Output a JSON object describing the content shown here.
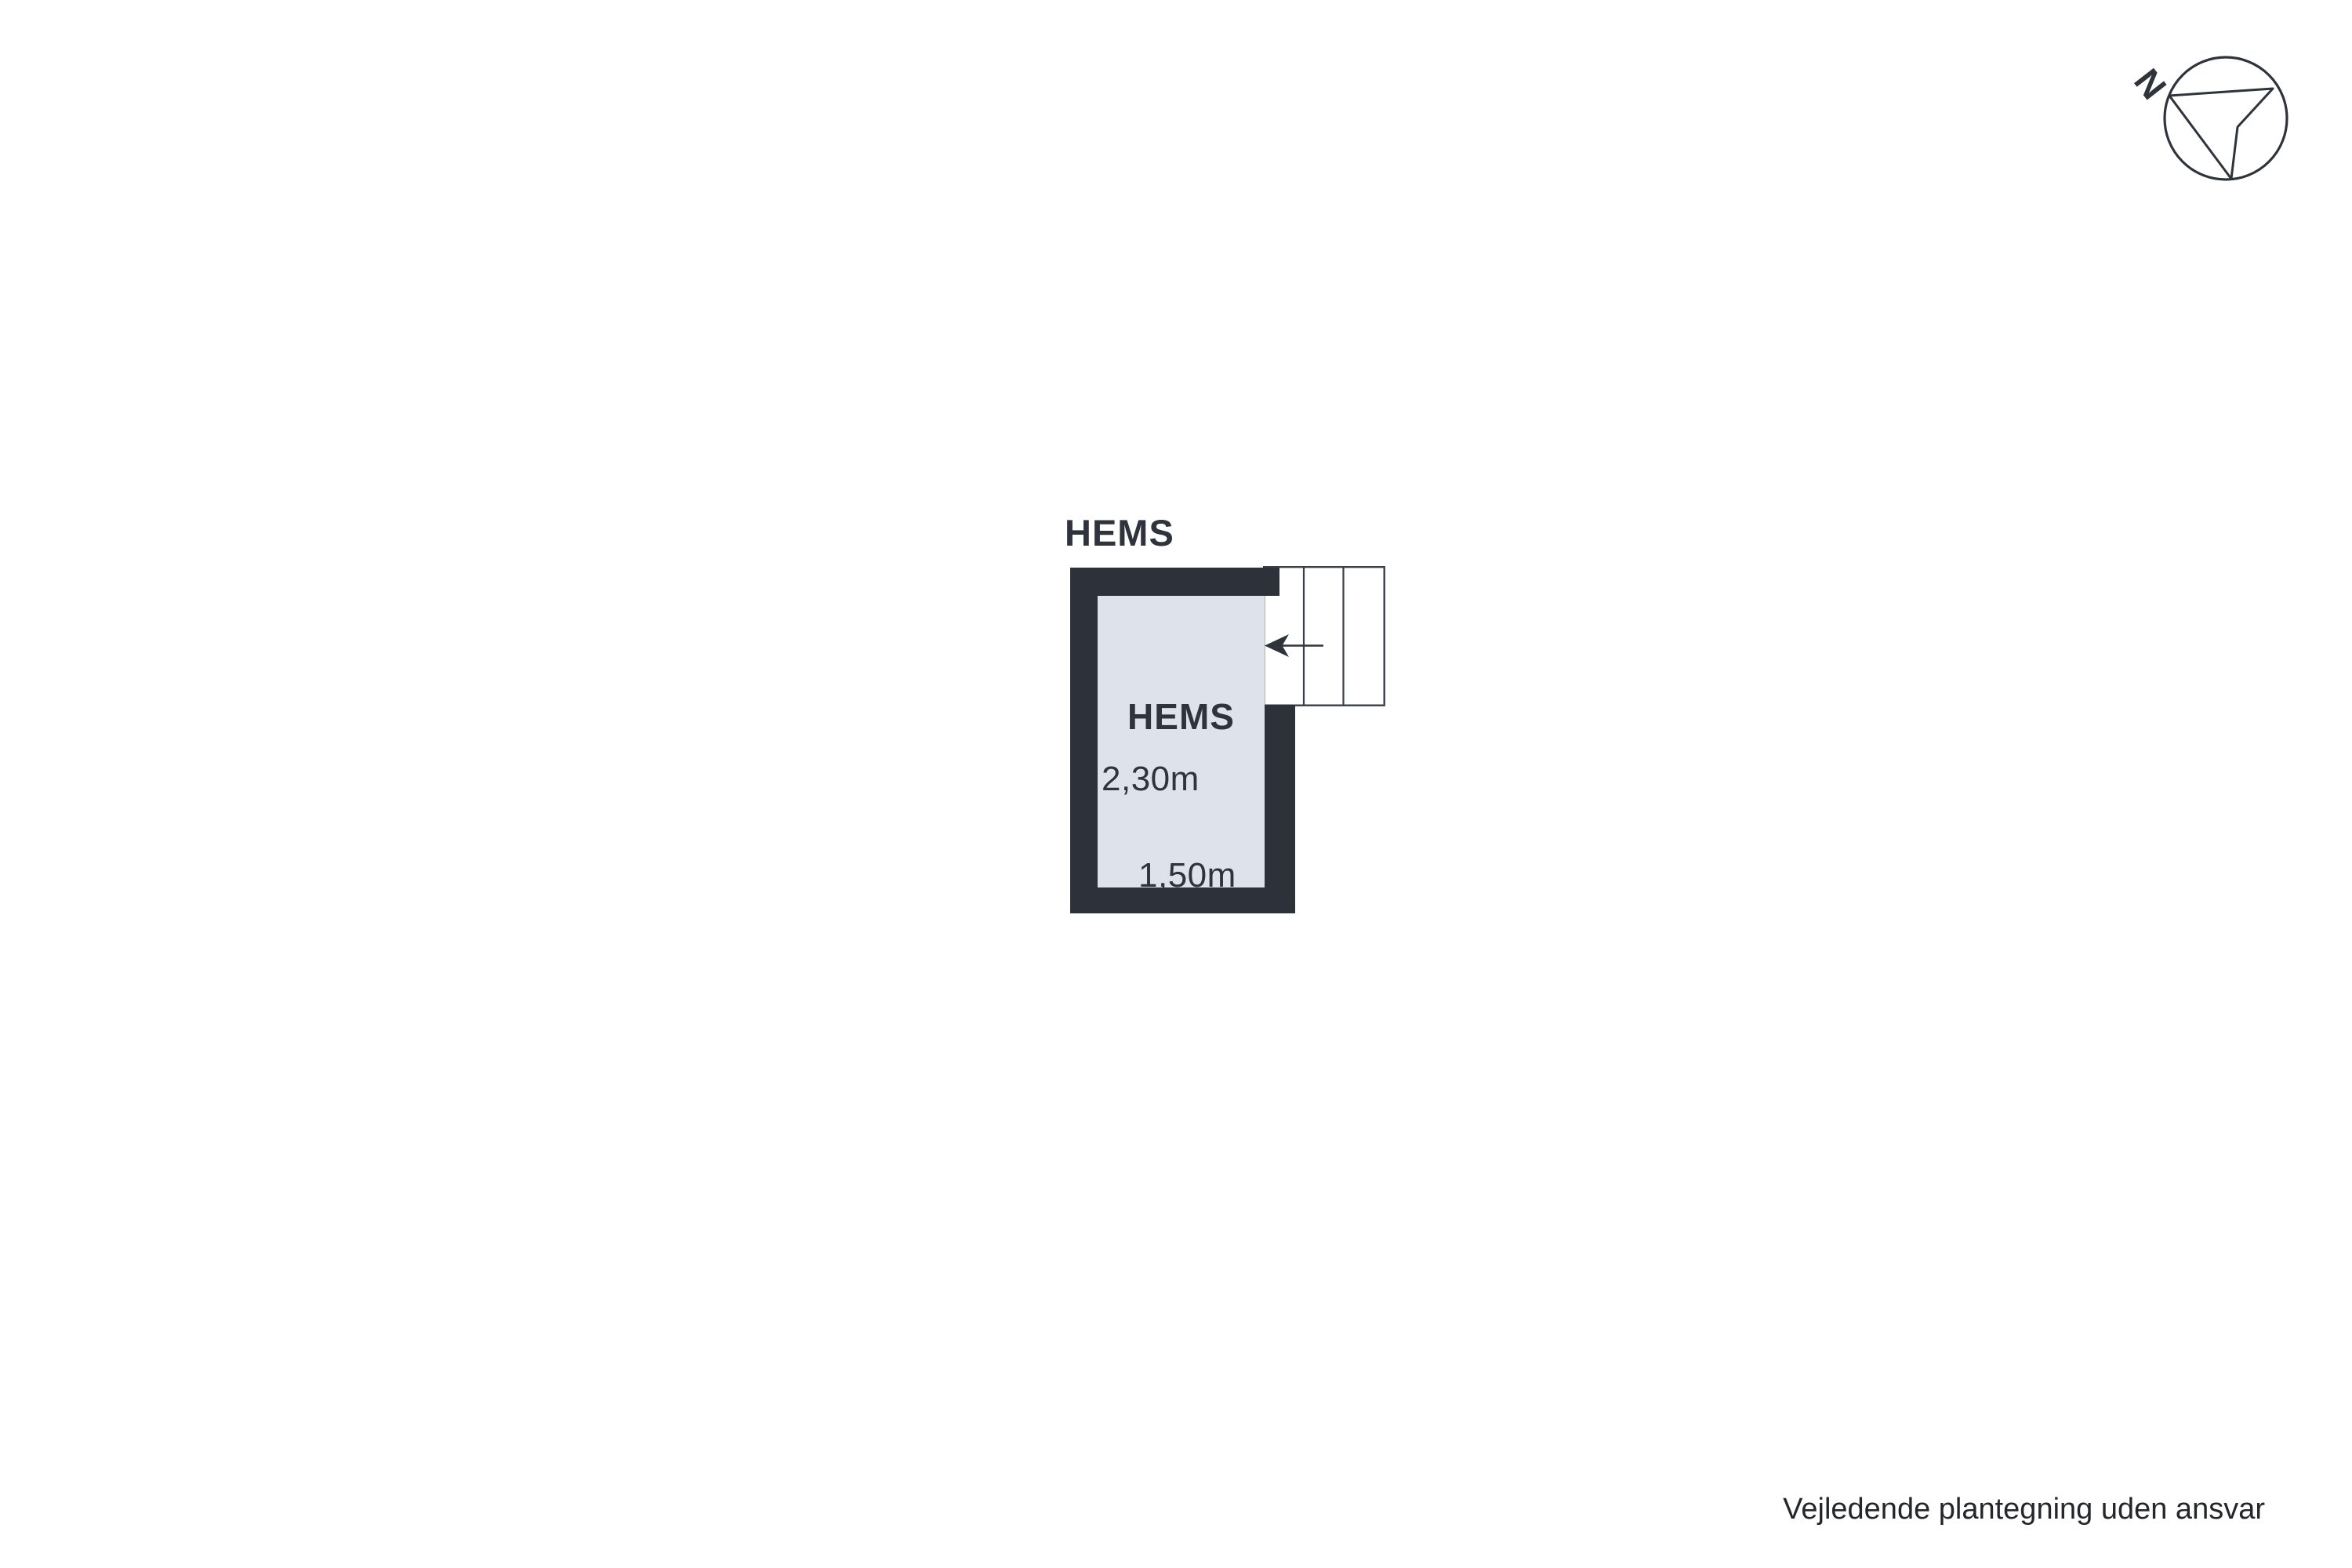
{
  "compass": {
    "north_label": "N"
  },
  "plan": {
    "title": "HEMS",
    "room": {
      "name": "HEMS",
      "ceiling_height": "2,30m",
      "width": "1,50m"
    },
    "stairs": {
      "tread_count": 3,
      "direction": "left"
    },
    "colors": {
      "wall": "#2d313a",
      "floor": "#dee2eb",
      "outline": "#3a3e47",
      "text": "#2f333c"
    }
  },
  "footer": {
    "disclaimer": "Vejledende plantegning uden ansvar"
  }
}
